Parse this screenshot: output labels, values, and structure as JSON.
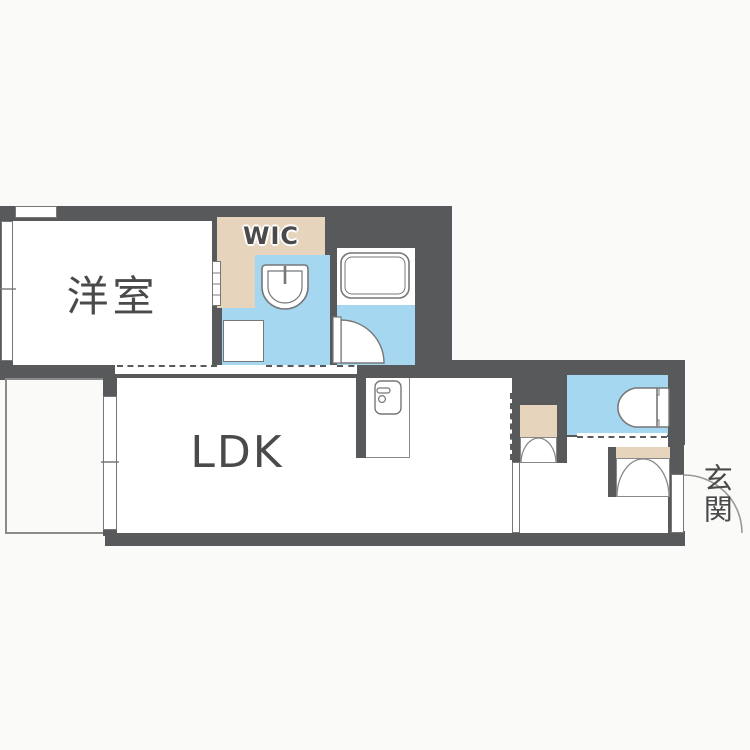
{
  "type": "floor-plan",
  "rooms": {
    "western_room": {
      "label": "洋室"
    },
    "wic": {
      "label": "WIC"
    },
    "ldk": {
      "label": "LDK"
    },
    "entrance": {
      "label": "玄関"
    }
  },
  "colors": {
    "wall": "#58595B",
    "water": "#A6D7F1",
    "closet": "#E6D5BC",
    "floor": "#FFFFFF",
    "bg": "#FAFAF8",
    "line": "#777777",
    "linelight": "#999999",
    "text": "#4A4A4A"
  },
  "icons": {
    "bathtub-icon": "double-outline rounded rectangle tub",
    "washbasin-icon": "round-bottom basin with faucet tick",
    "toilet-icon": "bullet-shaped bowl with cistern tank",
    "mini-kitchen-icon": "compact unit with handle bar and knob circle",
    "swing-door-icon": "quarter-circle door arc",
    "bifold-door-icon": "two meeting quarter arcs",
    "window-icon": "double-line window with center tick",
    "dashed-opening-icon": "dashed doorway line"
  }
}
